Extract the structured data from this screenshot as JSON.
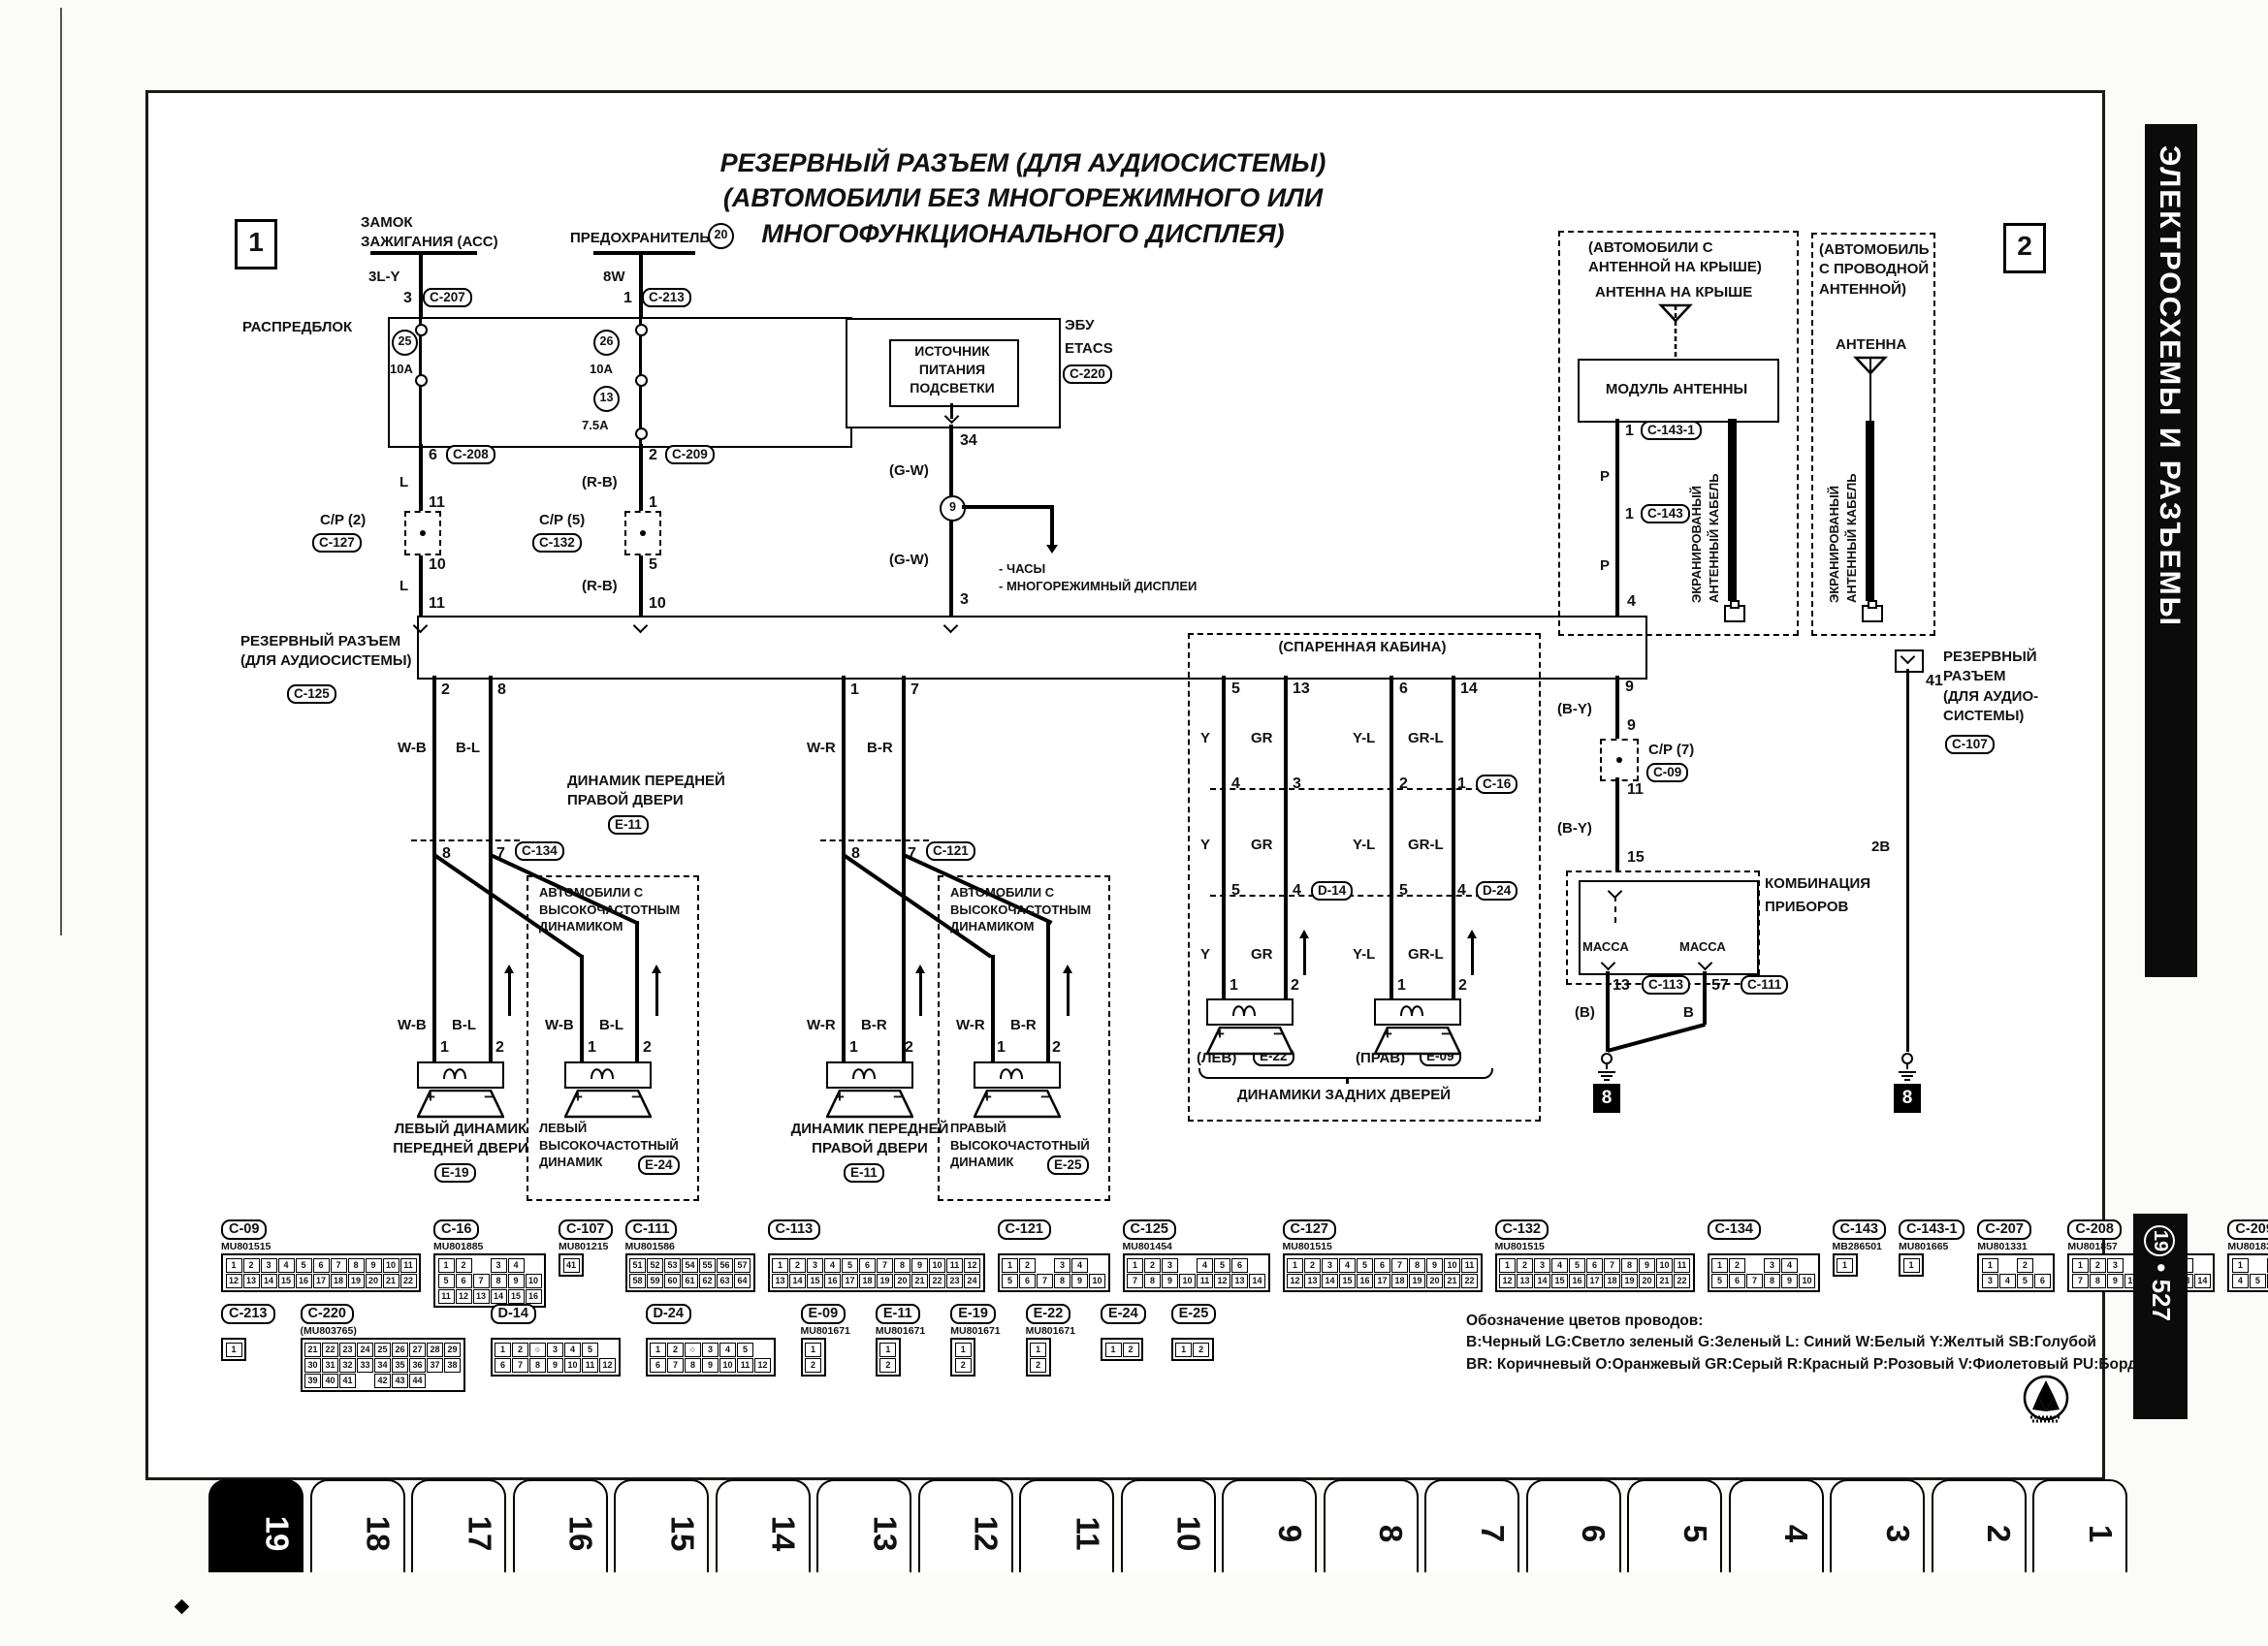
{
  "sidebar": {
    "title": "ЭЛЕКТРОСХЕМЫ И РАЗЪЕМЫ",
    "page_circled": "19",
    "page_sep": "•",
    "page_num": "527"
  },
  "tabs": {
    "items": [
      "19",
      "18",
      "17",
      "16",
      "15",
      "14",
      "13",
      "12",
      "11",
      "10",
      "9",
      "8",
      "7",
      "6",
      "5",
      "4",
      "3",
      "2",
      "1"
    ],
    "selected": "19"
  },
  "markers": {
    "m1": "1",
    "m2": "2",
    "g_left": "8",
    "g_right": "8"
  },
  "title": {
    "l1": "РЕЗЕРВНЫЙ РАЗЪЕМ (ДЛЯ АУДИОСИСТЕМЫ)",
    "l2": "(АВТОМОБИЛИ БЕЗ МНОГОРЕЖИМНОГО ИЛИ",
    "l3": "МНОГОФУНКЦИОНАЛЬНОГО ДИСПЛЕЯ)"
  },
  "ignition": {
    "l1": "ЗАМОК",
    "l2": "ЗАЖИГАНИЯ (АСС)",
    "wire": "3L-Y",
    "pin": "3",
    "conn": "C-207"
  },
  "fuse": {
    "label": "ПРЕДОХРАНИТЕЛЬ",
    "num": "20",
    "wire": "8W",
    "pin": "1",
    "conn": "C-213"
  },
  "dist": {
    "label": "РАСПРЕДБЛОК",
    "f1": "25",
    "f1a": "10A",
    "f2": "26",
    "f2a": "10A",
    "f3": "13",
    "f3a": "7.5A"
  },
  "feedL": {
    "p1": "6",
    "c1": "C-208",
    "w1": "L",
    "p2": "11",
    "cp": "C/P (2)",
    "cpc": "C-127",
    "p3": "10",
    "w2": "L",
    "p4": "11"
  },
  "feedR": {
    "p1": "2",
    "c1": "C-209",
    "w1": "(R-B)",
    "p2": "1",
    "cp": "C/P (5)",
    "cpc": "C-132",
    "p3": "5",
    "w2": "(R-B)",
    "p4": "10"
  },
  "etacs": {
    "b1": "ИСТОЧНИК",
    "b2": "ПИТАНИЯ",
    "b3": "ПОДСВЕТКИ",
    "n1": "ЭБУ",
    "n2": "ETACS",
    "conn": "C-220",
    "pin": "34",
    "w1": "(G-W)",
    "j": "9",
    "note1": "- ЧАСЫ",
    "note2": "- МНОГОРЕЖИМНЫЙ ДИСПЛЕИ",
    "w2": "(G-W)",
    "pin2": "3"
  },
  "bus": {
    "l1": "РЕЗЕРВНЫЙ РАЗЪЕМ",
    "l2": "(ДЛЯ АУДИОСИСТЕМЫ)",
    "conn": "C-125"
  },
  "hfnote": {
    "l1": "АВТОМОБИЛИ С",
    "l2": "ВЫСОКОЧАСТОТНЫМ",
    "l3": "ДИНАМИКОМ"
  },
  "fl": {
    "p1": "2",
    "p2": "8",
    "w1": "W-B",
    "w2": "B-L",
    "jp1": "8",
    "jp2": "7",
    "conn": "C-134",
    "w1b": "W-B",
    "w2b": "B-L",
    "w1c": "W-B",
    "w2c": "B-L",
    "s1": "1",
    "s2": "2",
    "t1": "1",
    "t2": "2",
    "n1": "ЛЕВЫЙ ДИНАМИК",
    "n2": "ПЕРЕДНЕЙ ДВЕРИ",
    "code": "E-19",
    "tw1": "ЛЕВЫЙ",
    "tw2": "ВЫСОКОЧАСТОТНЫЙ",
    "tw3": "ДИНАМИК",
    "twcode": "E-24"
  },
  "fr": {
    "top1": "ДИНАМИК ПЕРЕДНЕЙ",
    "top2": "ПРАВОЙ ДВЕРИ",
    "topcode": "E-11",
    "p1": "1",
    "p2": "7",
    "w1": "W-R",
    "w2": "B-R",
    "jp1": "8",
    "jp2": "7",
    "conn": "C-121",
    "w1b": "W-R",
    "w2b": "B-R",
    "w1c": "W-R",
    "w2c": "B-R",
    "s1": "1",
    "s2": "2",
    "t1": "1",
    "t2": "2",
    "n1": "ДИНАМИК ПЕРЕДНЕЙ",
    "n2": "ПРАВОЙ ДВЕРИ",
    "code": "E-11",
    "tw1": "ПРАВЫЙ",
    "tw2": "ВЫСОКОЧАСТОТНЫЙ",
    "tw3": "ДИНАМИК",
    "twcode": "E-25"
  },
  "rear": {
    "cab": "(СПАРЕННАЯ КАБИНА)",
    "p1": "5",
    "p2": "13",
    "p3": "6",
    "p4": "14",
    "wa1": "Y",
    "wa2": "GR",
    "wa3": "Y-L",
    "wa4": "GR-L",
    "m1p1": "4",
    "m1p2": "3",
    "m1p3": "2",
    "m1p4": "1",
    "m1c": "C-16",
    "wb1": "Y",
    "wb2": "GR",
    "wb3": "Y-L",
    "wb4": "GR-L",
    "m2p1": "5",
    "m2p2": "4",
    "m2cl": "D-14",
    "m2p3": "5",
    "m2p4": "4",
    "m2cr": "D-24",
    "wc1": "Y",
    "wc2": "GR",
    "wc3": "Y-L",
    "wc4": "GR-L",
    "s1": "1",
    "s2": "2",
    "s3": "1",
    "s4": "2",
    "lt": "(ЛЕВ)",
    "lc": "E-22",
    "rt": "(ПРАВ)",
    "rc": "E-09",
    "cap": "ДИНАМИКИ ЗАДНИХ ДВЕРЕЙ"
  },
  "meter": {
    "p9a": "9",
    "w1": "(B-Y)",
    "p9b": "9",
    "cp": "C/P (7)",
    "cpc": "C-09",
    "p11": "11",
    "w2": "(B-Y)",
    "p15": "15",
    "n1": "КОМБИНАЦИЯ",
    "n2": "ПРИБОРОВ",
    "m1": "МАССА",
    "m2": "МАССА",
    "p13": "13",
    "c13": "C-113",
    "p57": "57",
    "c57": "C-111",
    "wl": "(В)",
    "wr": "B"
  },
  "c107": {
    "pin": "41",
    "l1": "РЕЗЕРВНЫЙ",
    "l2": "РАЗЪЕМ",
    "l3": "(ДЛЯ АУДИО-",
    "l4": "СИСТЕМЫ)",
    "conn": "C-107",
    "wire": "2B"
  },
  "ant": {
    "n1": "(АВТОМОБИЛИ С",
    "n2": "АНТЕННОЙ НА КРЫШЕ)",
    "roof": "АНТЕННА НА КРЫШЕ",
    "module": "МОДУЛЬ АНТЕННЫ",
    "p1": "1",
    "c1": "C-143-1",
    "w1": "P",
    "p2": "1",
    "c2": "C-143",
    "w2": "P",
    "p4": "4",
    "cab1": "ЭКРАНИРОВАНЫЙ",
    "cab2": "АНТЕННЫЙ КАБЕЛЬ",
    "wn1": "(АВТОМОБИЛЬ",
    "wn2": "С ПРОВОДНОЙ",
    "wn3": "АНТЕННОЙ)",
    "ant": "АНТЕННА",
    "cab3": "ЭКРАНИРОВАНЫЙ",
    "cab4": "АНТЕННЫЙ КАБЕЛЬ"
  },
  "sym": {
    "plus": "+",
    "minus": "−"
  },
  "legend": {
    "t": "Обозначение цветов проводов:",
    "l1": "В:Черный LG:Светло зеленый G:Зеленый L: Синий W:Белый Y:Желтый SB:Голубой",
    "l2": "BR: Коричневый О:Оранжевый GR:Серый R:Красный Р:Розовый V:Фиолетовый PU:Бордовый"
  },
  "connector_table": [
    [
      {
        "id": "C-09",
        "part": "MU801515",
        "pins": [
          [
            "1",
            "2",
            "3",
            "4",
            "5",
            "6",
            "7",
            "8",
            "9",
            "10",
            "11"
          ],
          [
            "12",
            "13",
            "14",
            "15",
            "16",
            "17",
            "18",
            "19",
            "20",
            "21",
            "22"
          ]
        ]
      },
      {
        "id": "C-16",
        "part": "MU801885",
        "pins": [
          [
            "1",
            "2",
            "",
            "3",
            "4"
          ],
          [
            "5",
            "6",
            "7",
            "8",
            "9",
            "10"
          ],
          [
            "11",
            "12",
            "13",
            "14",
            "15",
            "16"
          ]
        ]
      },
      {
        "id": "C-107",
        "part": "MU801215",
        "pins": [
          [
            "41"
          ]
        ]
      },
      {
        "id": "C-111",
        "part": "MU801586",
        "pins": [
          [
            "51",
            "52",
            "53",
            "54",
            "55",
            "56",
            "57"
          ],
          [
            "58",
            "59",
            "60",
            "61",
            "62",
            "63",
            "64"
          ]
        ]
      },
      {
        "id": "C-113",
        "part": "",
        "pins": [
          [
            "1",
            "2",
            "3",
            "4",
            "5",
            "6",
            "7",
            "8",
            "9",
            "10",
            "11",
            "12"
          ],
          [
            "13",
            "14",
            "15",
            "16",
            "17",
            "18",
            "19",
            "20",
            "21",
            "22",
            "23",
            "24"
          ]
        ]
      },
      {
        "id": "C-121",
        "part": "",
        "pins": [
          [
            "1",
            "2",
            "",
            "3",
            "4"
          ],
          [
            "5",
            "6",
            "7",
            "8",
            "9",
            "10"
          ]
        ]
      },
      {
        "id": "C-125",
        "part": "MU801454",
        "pins": [
          [
            "1",
            "2",
            "3",
            "",
            "4",
            "5",
            "6"
          ],
          [
            "7",
            "8",
            "9",
            "10",
            "11",
            "12",
            "13",
            "14"
          ]
        ]
      },
      {
        "id": "C-127",
        "part": "MU801515",
        "pins": [
          [
            "1",
            "2",
            "3",
            "4",
            "5",
            "6",
            "7",
            "8",
            "9",
            "10",
            "11"
          ],
          [
            "12",
            "13",
            "14",
            "15",
            "16",
            "17",
            "18",
            "19",
            "20",
            "21",
            "22"
          ]
        ]
      },
      {
        "id": "C-132",
        "part": "MU801515",
        "pins": [
          [
            "1",
            "2",
            "3",
            "4",
            "5",
            "6",
            "7",
            "8",
            "9",
            "10",
            "11"
          ],
          [
            "12",
            "13",
            "14",
            "15",
            "16",
            "17",
            "18",
            "19",
            "20",
            "21",
            "22"
          ]
        ]
      },
      {
        "id": "C-134",
        "part": "",
        "pins": [
          [
            "1",
            "2",
            "",
            "3",
            "4"
          ],
          [
            "5",
            "6",
            "7",
            "8",
            "9",
            "10"
          ]
        ]
      },
      {
        "id": "C-143",
        "part": "MB286501",
        "pins": [
          [
            "1"
          ]
        ]
      },
      {
        "id": "C-143-1",
        "part": "MU801665",
        "pins": [
          [
            "1"
          ]
        ]
      },
      {
        "id": "C-207",
        "part": "MU801331",
        "pins": [
          [
            "1",
            "",
            "2"
          ],
          [
            "3",
            "4",
            "5",
            "6"
          ]
        ]
      },
      {
        "id": "C-208",
        "part": "MU801857",
        "pins": [
          [
            "1",
            "2",
            "3",
            "",
            "4",
            "5",
            "6"
          ],
          [
            "7",
            "8",
            "9",
            "10",
            "11",
            "12",
            "13",
            "14"
          ]
        ]
      },
      {
        "id": "C-209",
        "part": "MU801839",
        "pins": [
          [
            "1",
            "",
            "2",
            "3"
          ],
          [
            "4",
            "5",
            "6",
            "7",
            "8"
          ]
        ]
      }
    ],
    [
      {
        "id": "C-213",
        "part": "",
        "pins": [
          [
            "1"
          ]
        ]
      },
      {
        "id": "C-220",
        "part": "(MU803765)",
        "pins": [
          [
            "21",
            "22",
            "23",
            "24",
            "25",
            "26",
            "27",
            "28",
            "29"
          ],
          [
            "30",
            "31",
            "32",
            "33",
            "34",
            "35",
            "36",
            "37",
            "38"
          ],
          [
            "39",
            "40",
            "41",
            "",
            "42",
            "43",
            "44"
          ]
        ]
      },
      {
        "id": "D-14",
        "part": "",
        "pins": [
          [
            "1",
            "2",
            "○",
            "3",
            "4",
            "5"
          ],
          [
            "6",
            "7",
            "8",
            "9",
            "10",
            "11",
            "12"
          ]
        ]
      },
      {
        "id": "D-24",
        "part": "",
        "pins": [
          [
            "1",
            "2",
            "○",
            "3",
            "4",
            "5"
          ],
          [
            "6",
            "7",
            "8",
            "9",
            "10",
            "11",
            "12"
          ]
        ]
      },
      {
        "id": "E-09",
        "part": "MU801671",
        "pins": [
          [
            "1"
          ],
          [
            "2"
          ]
        ]
      },
      {
        "id": "E-11",
        "part": "MU801671",
        "pins": [
          [
            "1"
          ],
          [
            "2"
          ]
        ]
      },
      {
        "id": "E-19",
        "part": "MU801671",
        "pins": [
          [
            "1"
          ],
          [
            "2"
          ]
        ]
      },
      {
        "id": "E-22",
        "part": "MU801671",
        "pins": [
          [
            "1"
          ],
          [
            "2"
          ]
        ]
      },
      {
        "id": "E-24",
        "part": "",
        "pins": [
          [
            "1",
            "2"
          ]
        ]
      },
      {
        "id": "E-25",
        "part": "",
        "pins": [
          [
            "1",
            "2"
          ]
        ]
      }
    ]
  ]
}
